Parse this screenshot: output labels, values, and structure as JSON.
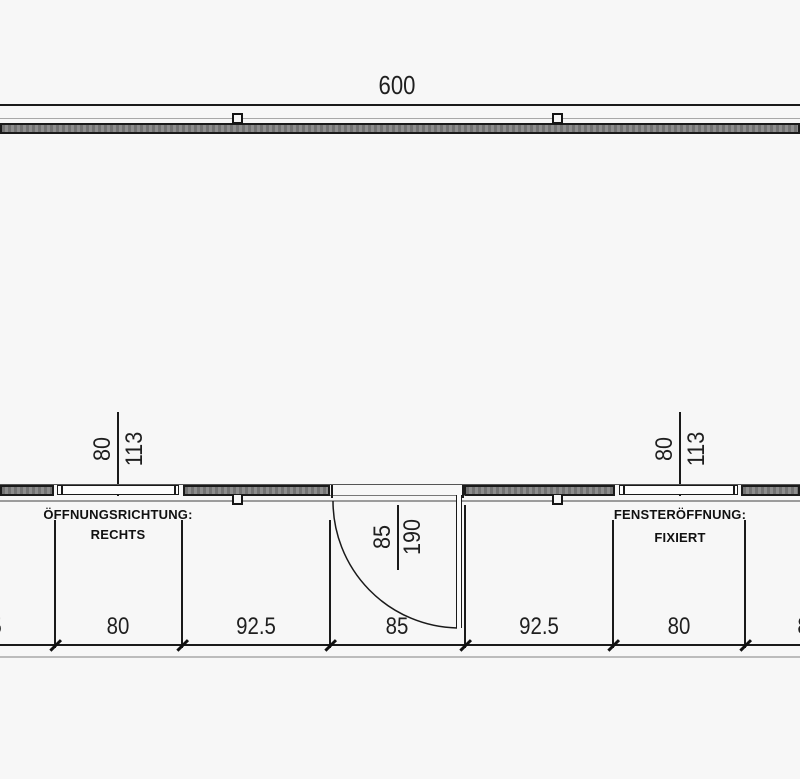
{
  "drawing": {
    "overall_width": "600",
    "left_window": {
      "dim_a": "80",
      "dim_b": "113",
      "note_line1": "ÖFFNUNGSRICHTUNG:",
      "note_line2": "RECHTS"
    },
    "door": {
      "dim_a": "85",
      "dim_b": "190"
    },
    "right_window": {
      "dim_a": "80",
      "dim_b": "113",
      "note_line1": "FENSTERÖFFNUNG:",
      "note_line2": "FIXIERT"
    },
    "bottom_dimensions": [
      "80",
      "92.5",
      "85",
      "92.5",
      "80"
    ],
    "edge_dimension_fragments": {
      "left": "5",
      "right": "8"
    }
  }
}
